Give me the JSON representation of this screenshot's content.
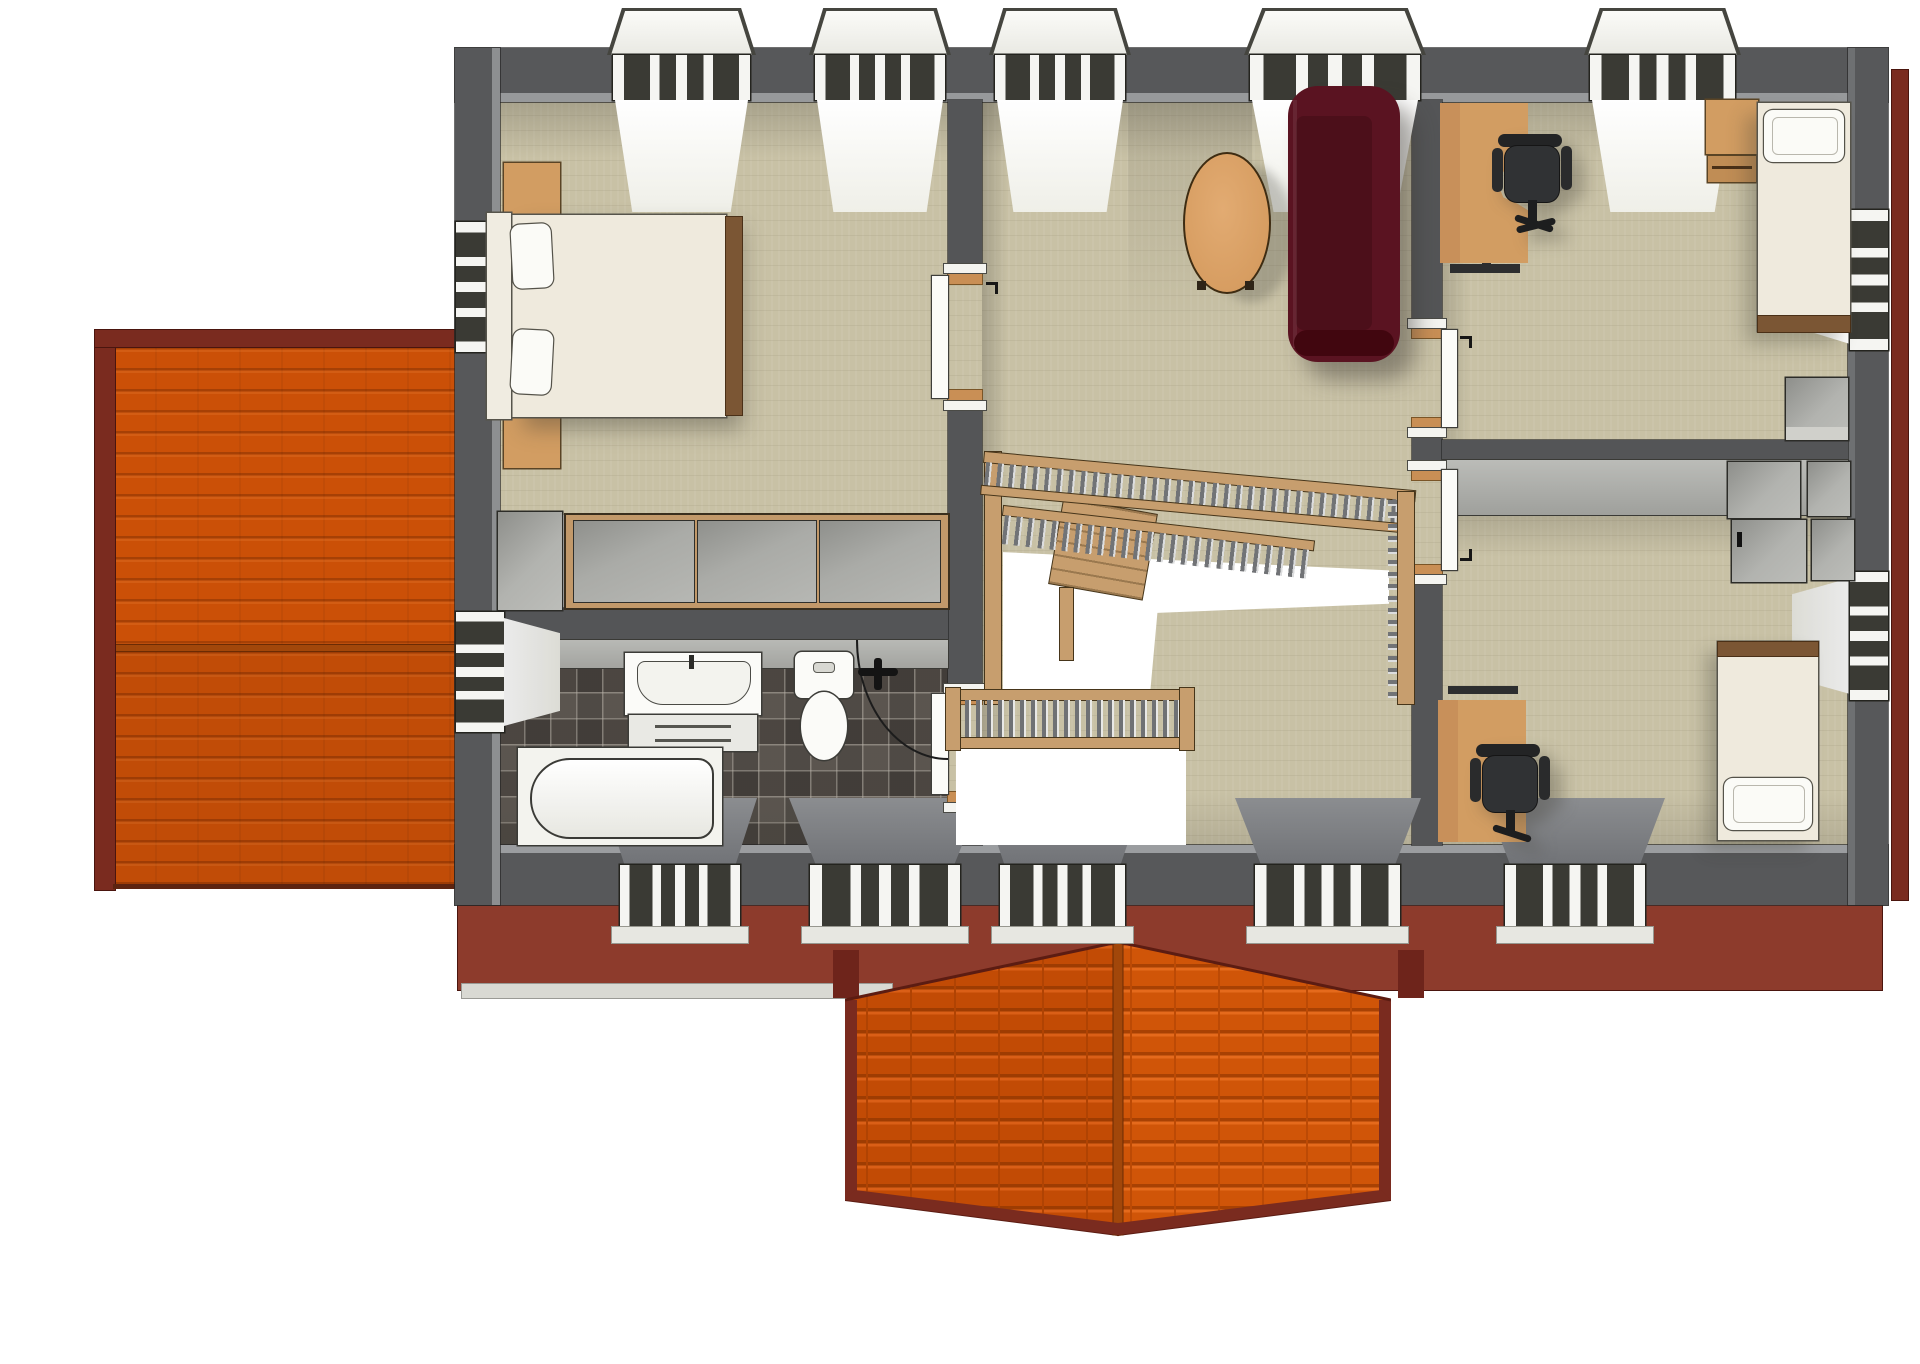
{
  "scene": {
    "type": "3d-floor-plan-render",
    "view": "top-down-axonometric",
    "storey": "upper-floor",
    "background": "#ffffff",
    "rooms": [
      {
        "name": "bedroom",
        "position": "top-left",
        "floor": "light-wood-plank",
        "furniture": [
          "double-bed",
          "headboard",
          "pillows x2",
          "nightstand x2",
          "wardrobe-sliding-panels x3",
          "side-cabinet"
        ]
      },
      {
        "name": "bathroom",
        "position": "bottom-left",
        "floor": "dark-mosaic-tile",
        "fixtures": [
          "vanity-sink-with-drawers",
          "toilet",
          "curved-corner-shower",
          "bathtub",
          "wall-mixer"
        ]
      },
      {
        "name": "living-hall",
        "position": "center",
        "floor": "light-wood-plank",
        "furniture": [
          "oval-coffee-table",
          "dark-red-sofa",
          "u-shaped-staircase-with-balustrade",
          "stairwell-void"
        ]
      },
      {
        "name": "study-bedroom-upper",
        "position": "top-right",
        "floor": "light-wood-plank",
        "furniture": [
          "corner-desk",
          "office-chair",
          "single-bed",
          "nightstand-with-shelf",
          "dresser"
        ]
      },
      {
        "name": "study-bedroom-lower",
        "position": "bottom-right",
        "floor": "light-wood-plank",
        "furniture": [
          "corner-desk",
          "office-chair",
          "single-bed",
          "appliance-cabinet x4"
        ]
      }
    ],
    "openings": {
      "windows_top": 5,
      "windows_bottom": 5,
      "windows_left": 2,
      "windows_right": 2,
      "interior_doors": 4
    },
    "roof_elements": [
      "left-gable-orange-tile-roof",
      "front-center-gable-orange-tile-roof",
      "maroon-fascia-band",
      "right-fascia-strip"
    ]
  },
  "palette": {
    "wall": "#57585a",
    "wallFace": "#97999b",
    "wallInt": "#545557",
    "floorWood": "#c8c1a5",
    "tileBase": "#544e48",
    "roofOrange": "#cb5007",
    "roofTrim": "#7a2b1f",
    "fascia": "#8d3b2c",
    "fasciaDark": "#5c1c12",
    "sofa": "#5a1321",
    "sofaSeat": "#4c0f1a",
    "tan": "#d29d62",
    "tanDark": "#5a4425",
    "stairWood": "#c79e6e",
    "cream": "#efeadd",
    "applianceGray": "#a9aaa6",
    "chair": "#303234",
    "frameDark": "#3a3a34",
    "windowWhite": "#f5f5f2"
  }
}
